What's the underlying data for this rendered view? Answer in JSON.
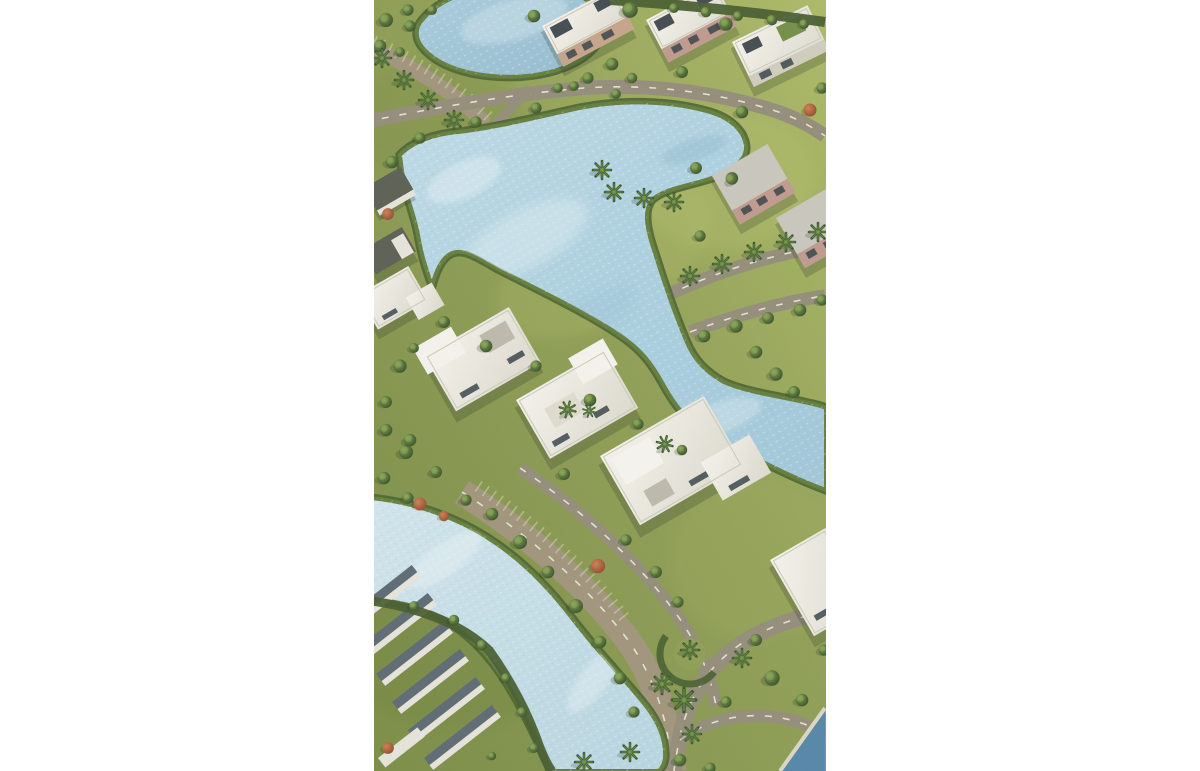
{
  "meta": {
    "type": "aerial-3d-render",
    "description": "Aerial master-plan render of a lagoon residential compound: white flat-roof villas and tan villas, rows of townhouses in the lower-left corner, three winding light-blue lagoons with green shores, curving grey streets with white dashed lane markings and angled parking bays, lawns dotted with round canopy trees, palm trees and a few red flowering trees. The portrait image is centered on a white page with wide white margins on both sides.",
    "alt": "Aerial view of villas, palm trees and winding blue lagoons in a green residential compound"
  },
  "canvas": {
    "page_width_px": 1200,
    "page_height_px": 771,
    "image_width_px": 452,
    "image_height_px": 771,
    "image_left_px": 374
  },
  "palette": {
    "page-bg": "#ffffff",
    "grass-light": "#a4b35e",
    "grass-mid": "#87984c",
    "grass-dark": "#708440",
    "hedge": "#3f5627",
    "tree-dark": "#2f4a22",
    "tree-mid": "#4c6a2f",
    "tree-light": "#86a352",
    "palm": "#3f6330",
    "palm-light": "#567b33",
    "flower-tree": "#a8523a",
    "water": "#a7cdde",
    "water-light": "#cde2ec",
    "water-deep": "#8fbdd2",
    "water-pale": "#c3dce7",
    "water-dark-corner": "#4d80a4",
    "shore": "#5d7733",
    "road": "#8e8774",
    "road-tan": "#9c9075",
    "road-mark": "#ece9dc",
    "roof-white": "#edebe3",
    "roof-grey": "#c6c3ba",
    "wall-tan": "#c2a085",
    "wall-pink": "#bd948a",
    "panel-dark": "#3b424a",
    "window-dark": "#2e3940",
    "townhouse-dark": "#56636e",
    "townhouse-light": "#e4e2d9",
    "beach": "#d8d4c0"
  },
  "scene": {
    "view": "tilted top-down aerial",
    "water_bodies": [
      "top lake",
      "central winding lagoon with north-east arm",
      "lower-left lagoon",
      "dark water wedge in bottom-right corner"
    ],
    "building_clusters": [
      "row of flat-roof tan and white villas along the top",
      "mauve-walled villas on the right side",
      "large white modern villas in the center with rooftop palms",
      "townhouse rows in the lower-left corner",
      "lakefront units clipped at the left edge"
    ],
    "vegetation": [
      "round canopy trees",
      "palm trees",
      "red flowering trees",
      "hedge bands",
      "roundabout hedge arc"
    ],
    "roads": [
      "curving streets with white dashed lane markings",
      "angled parking bays",
      "shore drive along the lower lagoon"
    ]
  }
}
